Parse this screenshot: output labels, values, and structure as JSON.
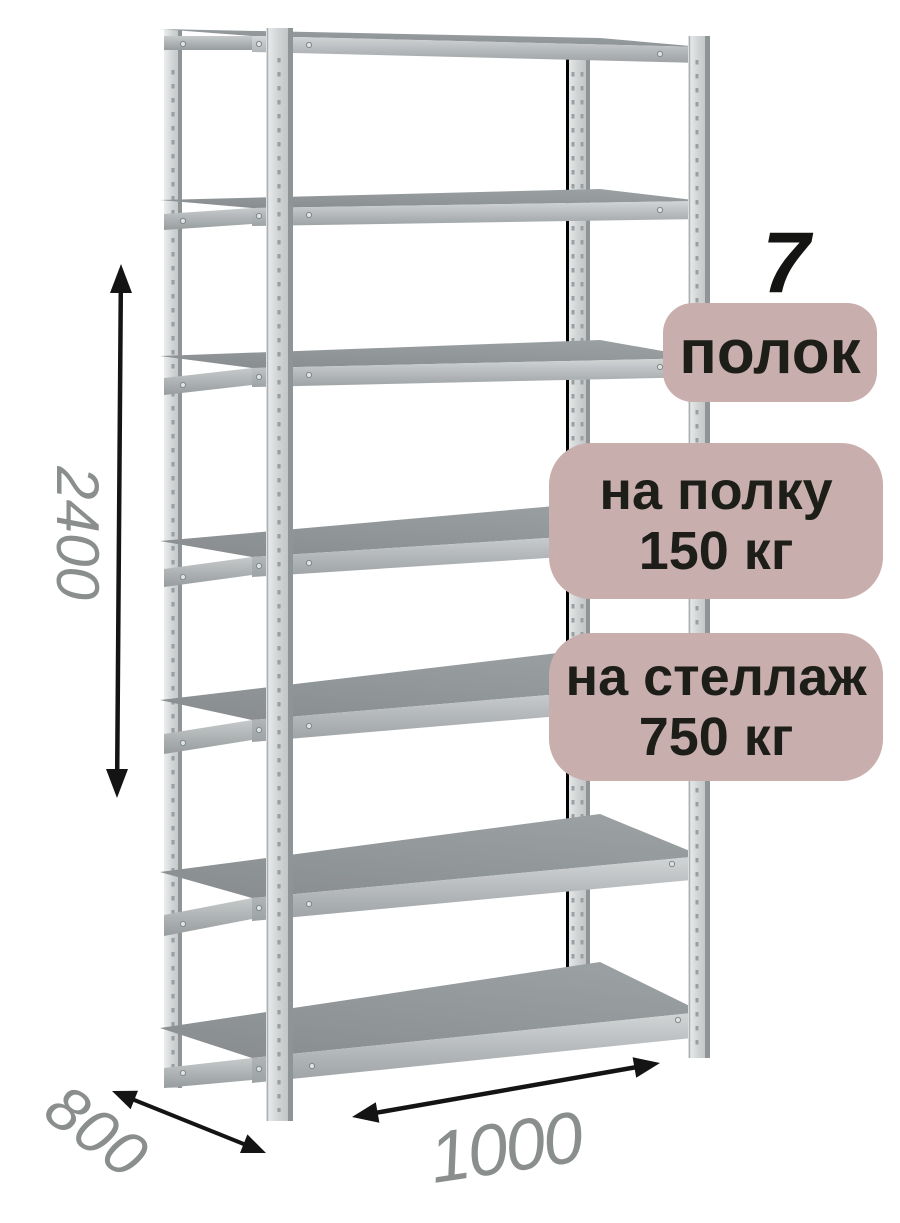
{
  "product": {
    "shelf_count": "7",
    "shelf_count_label": "полок",
    "per_shelf_load": {
      "line1": "на полку",
      "line2": "150 кг"
    },
    "per_rack_load": {
      "line1": "на стеллаж",
      "line2": "750 кг"
    }
  },
  "dimensions": {
    "height_mm": "2400",
    "depth_mm": "800",
    "width_mm": "1000"
  },
  "colors": {
    "badge_background": "#c9aeae",
    "badge_text": "#1d1e18",
    "dimension_text": "#8a8f8d",
    "arrow": "#141414",
    "shelf_top": "#8e9294",
    "metal_light": "#e8eaeb",
    "metal_dark": "#8f9597"
  }
}
